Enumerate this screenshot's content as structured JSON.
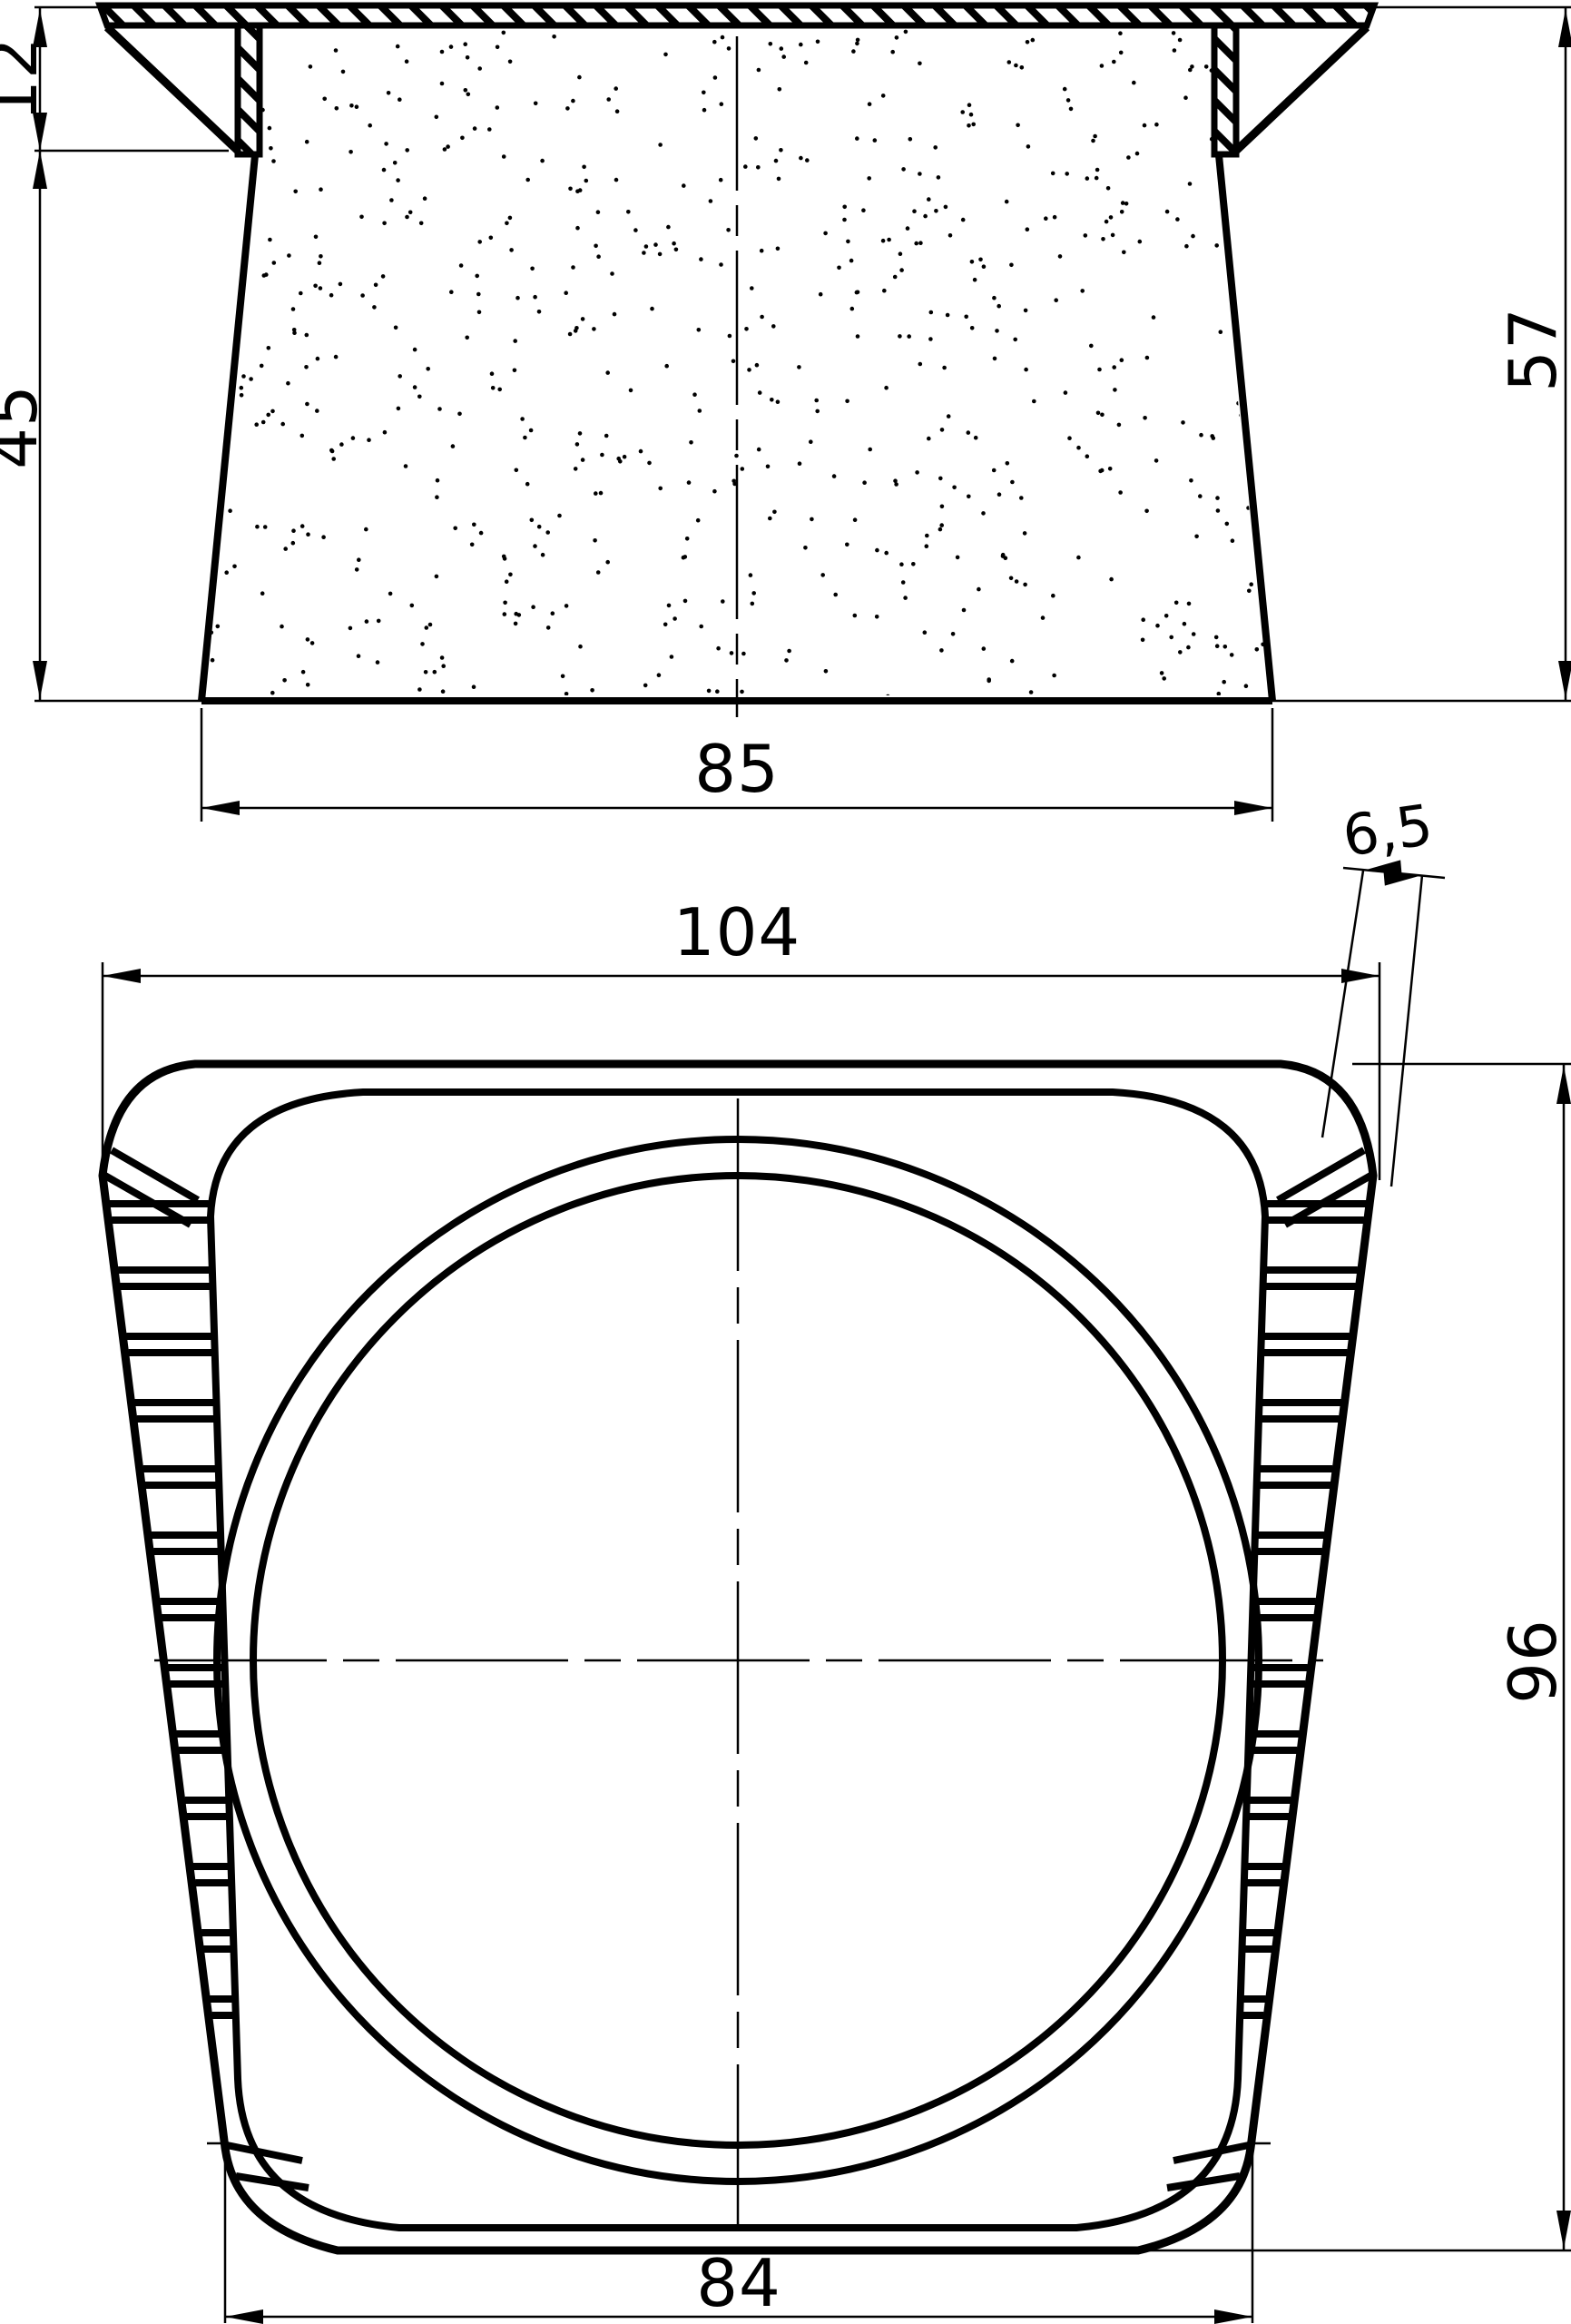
{
  "drawing": {
    "background_color": "#ffffff",
    "line_color": "#000000",
    "views": {
      "section_view": {
        "description": "upper cross-section view of tapered plug with hatched cap and stippled core",
        "dimensions": {
          "flange_skirt_height": "12",
          "body_height": "45",
          "total_height": "57",
          "bottom_width": "85"
        }
      },
      "plan_view": {
        "description": "lower plan view with ribbed tapered sides, rounded inner rim and circular cavity",
        "dimensions": {
          "top_width": "104",
          "corner_wall_thickness": "6,5",
          "height": "96",
          "bottom_width": "84"
        }
      }
    }
  }
}
